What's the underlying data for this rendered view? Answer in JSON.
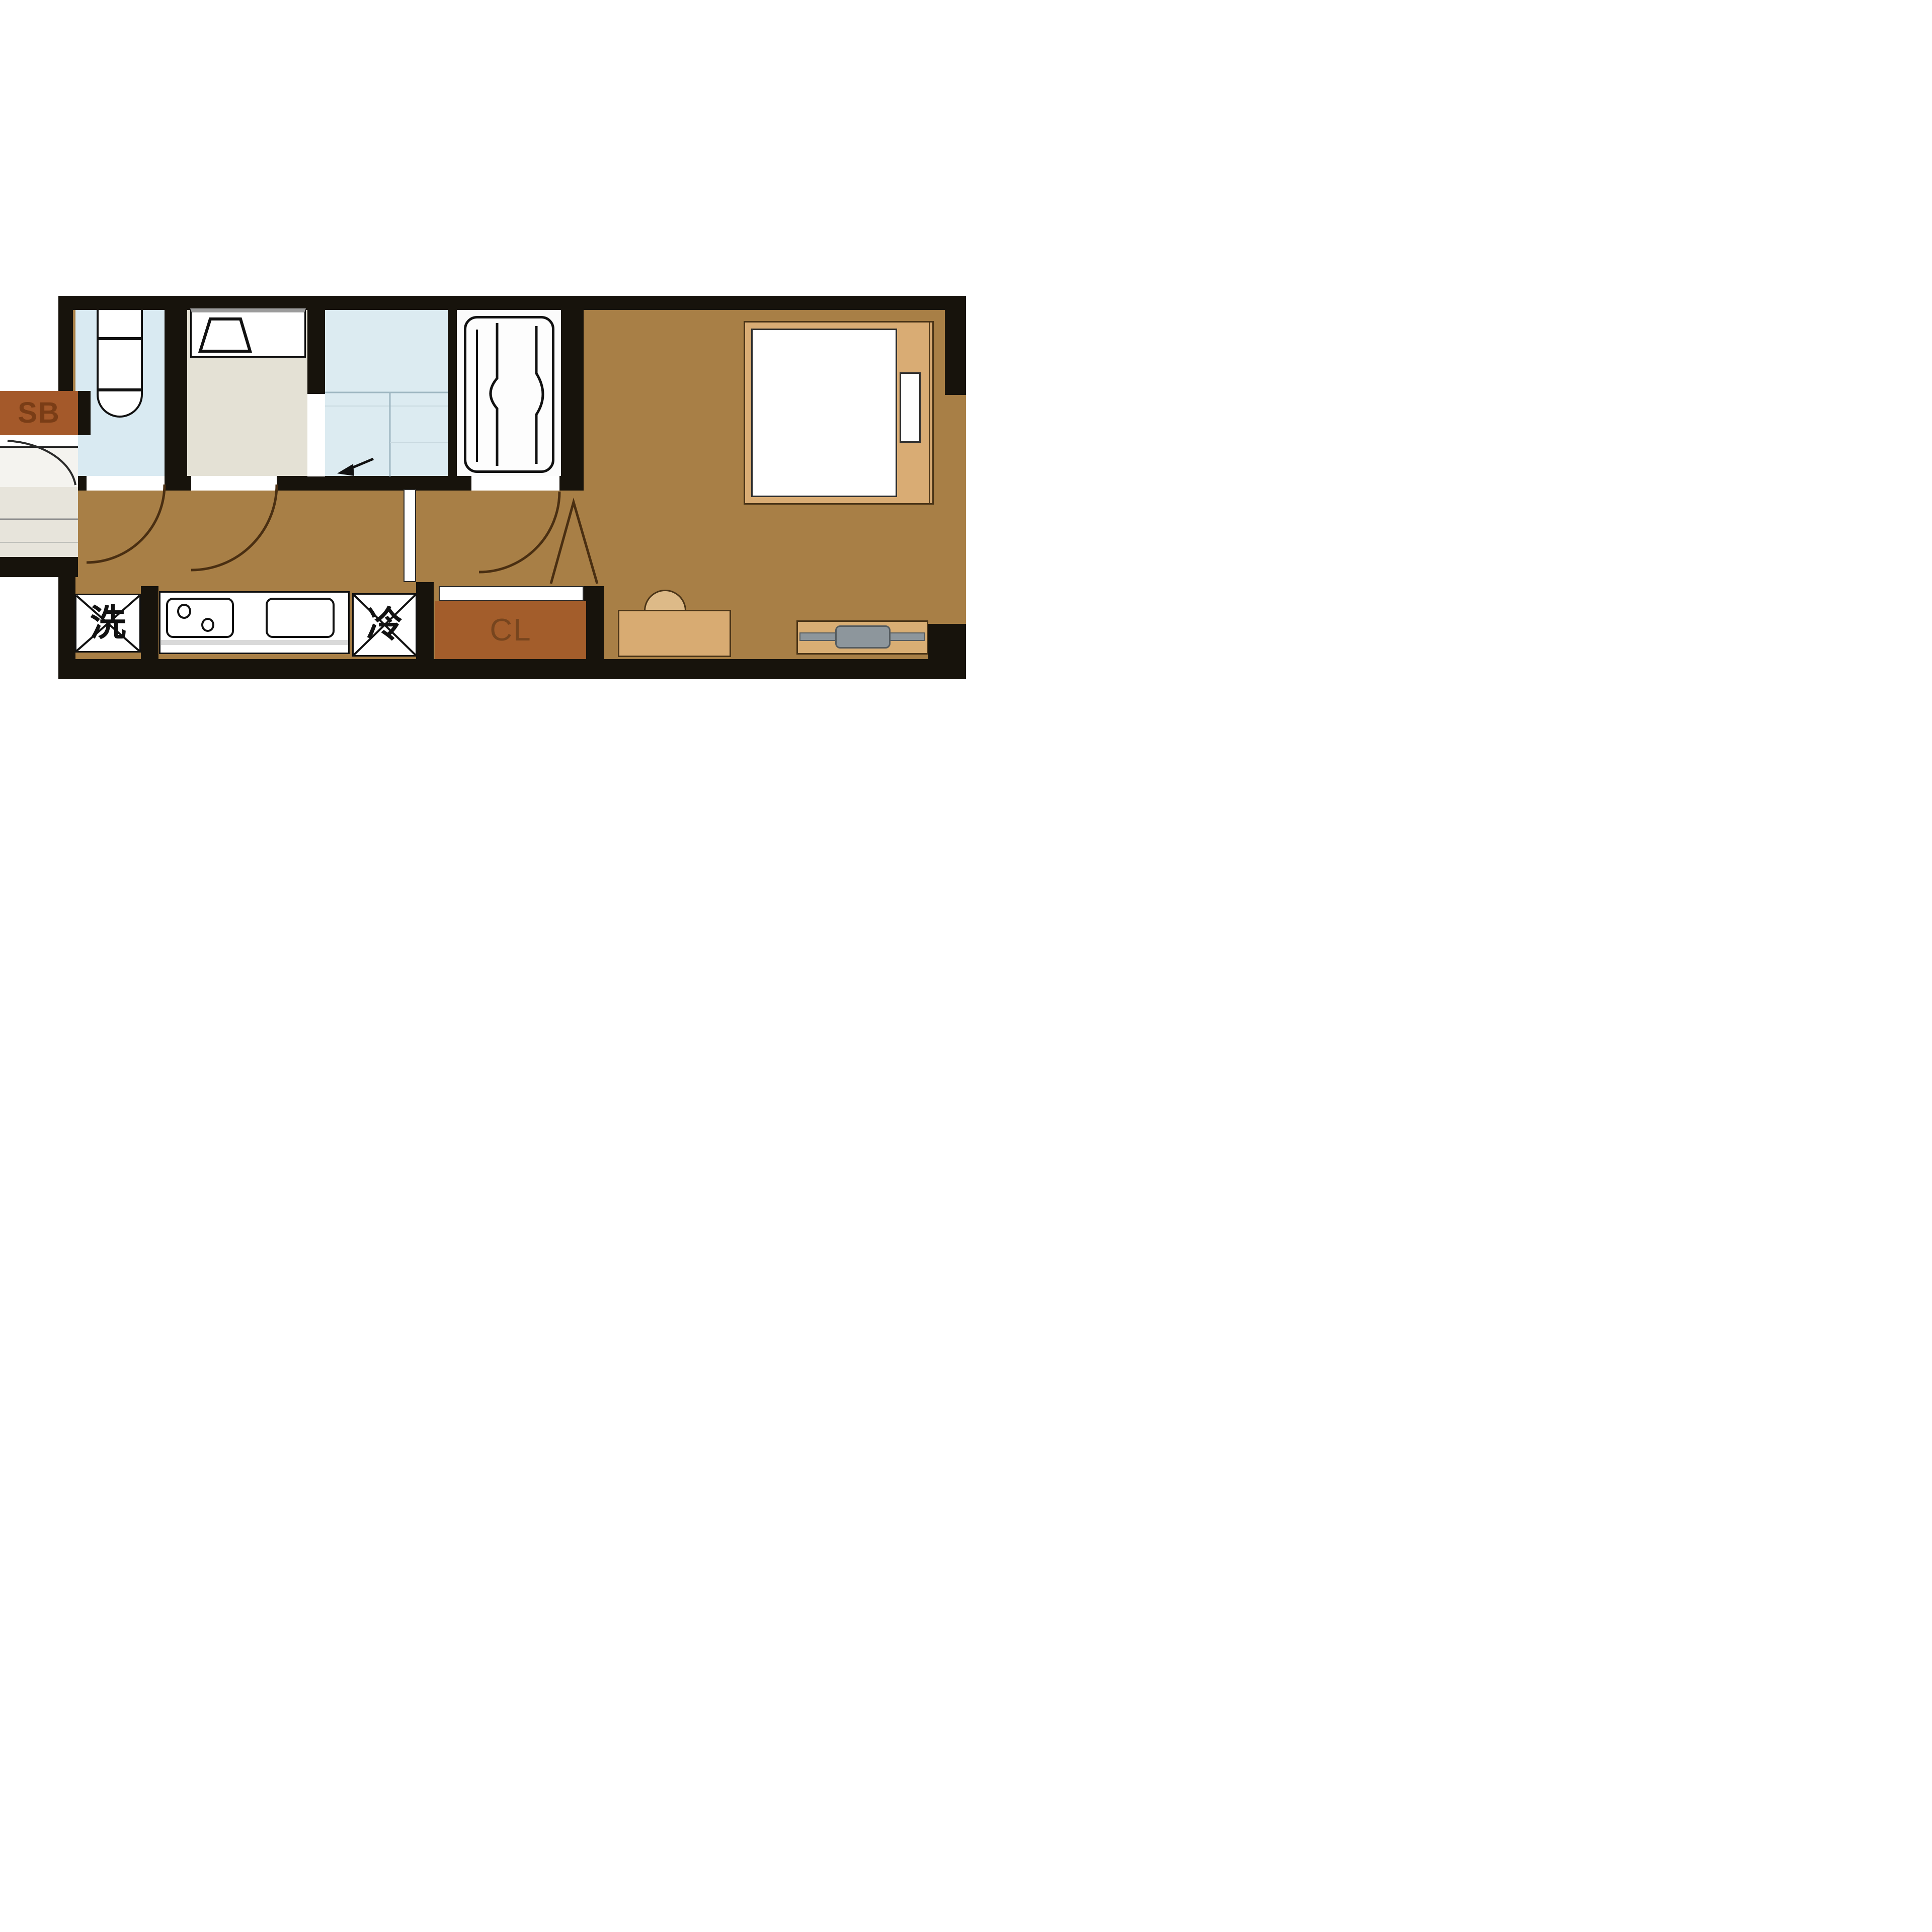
{
  "floorplan": {
    "type": "japanese-apartment-1k-floorplan",
    "labels": {
      "shoe_box": "SB",
      "closet": "CL",
      "washer": "洗",
      "refrigerator": "冷"
    },
    "rooms": [
      {
        "name": "toilet-room",
        "floor_color": "#d9eaf2"
      },
      {
        "name": "washroom",
        "floor_color": "#e4e1d5"
      },
      {
        "name": "shower-room",
        "floor_color": "#dcebf1"
      },
      {
        "name": "bathroom",
        "floor_color": "#fbfbfb"
      },
      {
        "name": "hallway-kitchen",
        "floor_color": "#a87f46"
      },
      {
        "name": "main-room",
        "floor_color": "#a87f46"
      },
      {
        "name": "entrance-genkan",
        "floor_color": "#e7e4db"
      }
    ],
    "fixtures": [
      "toilet",
      "washbasin",
      "bathtub",
      "stove",
      "kitchen-sink",
      "washing-machine",
      "refrigerator",
      "closet",
      "shoe-box",
      "bed",
      "pillow",
      "desk",
      "chair",
      "tv-board",
      "tv"
    ],
    "colors": {
      "wall": "#17130c",
      "floor_wood": "#a87f46",
      "wet_blue": "#d9eaf2",
      "washroom_beige": "#e4e1d5",
      "storage_rust": "#a4592a",
      "storage_text": "#7a3d16",
      "furniture_tan": "#d8ab72",
      "tv_gray": "#8d969c",
      "door_arc": "#4a2f12",
      "background": "#ffffff"
    }
  }
}
